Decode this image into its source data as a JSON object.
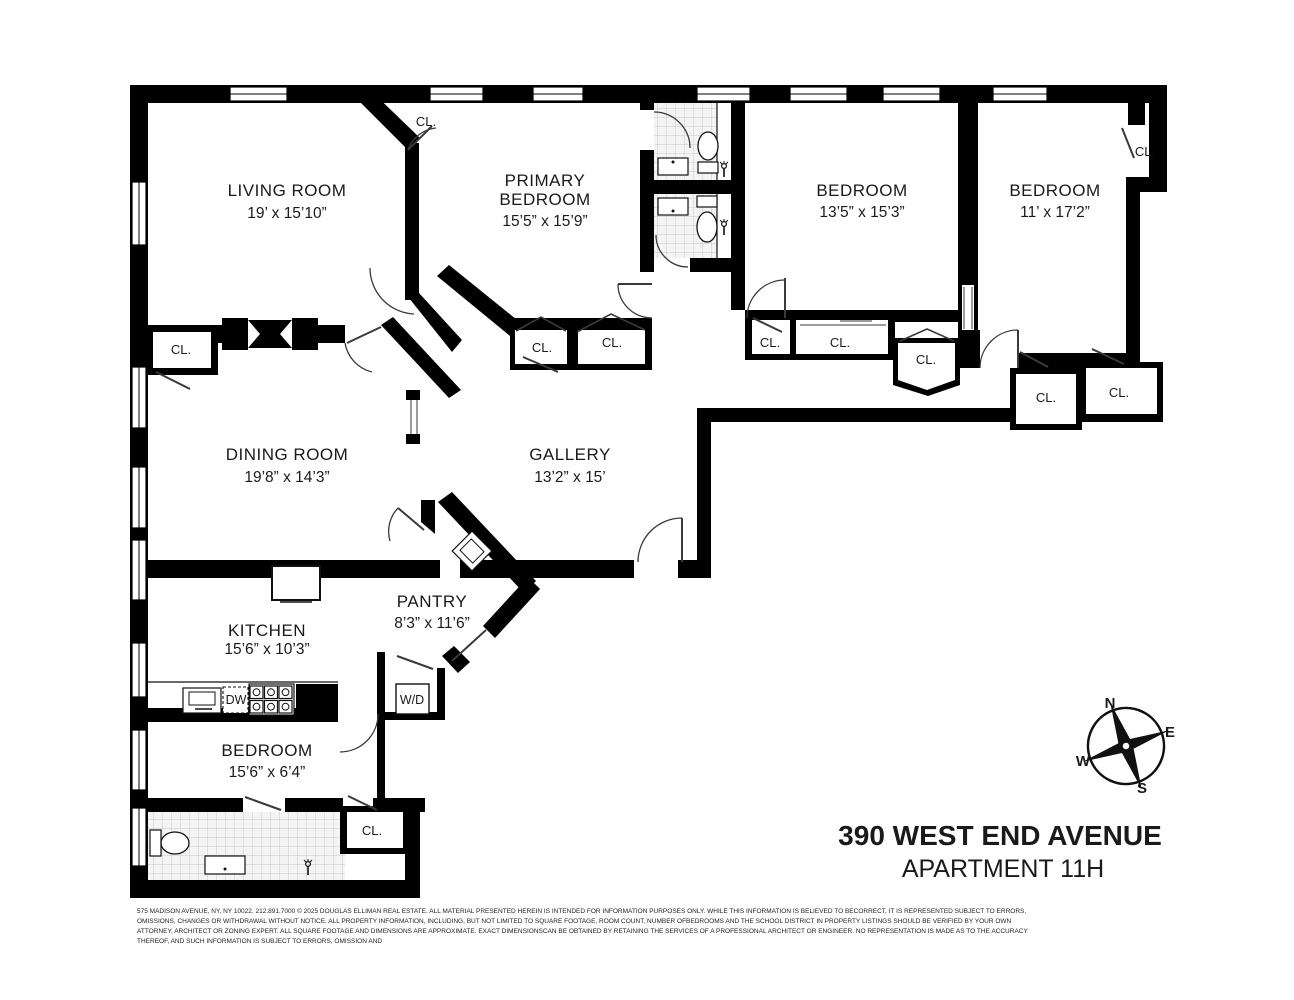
{
  "title": {
    "address": "390 WEST END AVENUE",
    "unit": "APARTMENT 11H"
  },
  "rooms": {
    "living": {
      "name": "LIVING ROOM",
      "dims": "19’ x 15’10”"
    },
    "primary": {
      "name1": "PRIMARY",
      "name2": "BEDROOM",
      "dims": "15’5” x 15’9”"
    },
    "bedroom2": {
      "name": "BEDROOM",
      "dims": "13’5” x 15’3”"
    },
    "bedroom3": {
      "name": "BEDROOM",
      "dims": "11’ x 17’2”"
    },
    "dining": {
      "name": "DINING ROOM",
      "dims": "19’8” x 14’3”"
    },
    "gallery": {
      "name": "GALLERY",
      "dims": "13’2” x 15’"
    },
    "pantry": {
      "name": "PANTRY",
      "dims": "8’3” x 11’6”"
    },
    "kitchen": {
      "name": "KITCHEN",
      "dims": "15’6” x 10’3”"
    },
    "bedroom4": {
      "name": "BEDROOM",
      "dims": "15’6” x 6’4”"
    }
  },
  "labels": {
    "closet": "CL.",
    "washer_dryer": "W/D",
    "dishwasher": "DW"
  },
  "compass": {
    "n": "N",
    "e": "E",
    "s": "S",
    "w": "W"
  },
  "colors": {
    "wall": "#000000",
    "background": "#ffffff",
    "tile_fill": "#f4f4f4",
    "tile_line": "#c9c9c9",
    "door_arc": "#3a3a3a"
  },
  "disclaimer": {
    "line1": "575 MADISON AVENUE, NY, NY 10022. 212.891.7000 © 2025 DOUGLAS ELLIMAN REAL ESTATE. ALL MATERIAL PRESENTED HEREIN IS INTENDED FOR INFORMATION PURPOSES ONLY. WHILE THIS INFORMATION IS BELIEVED TO BECORRECT, IT IS REPRESENTED SUBJECT TO ERRORS,",
    "line2": "OMISSIONS, CHANGES OR WITHDRAWAL WITHOUT NOTICE. ALL PROPERTY INFORMATION, INCLUDING, BUT NOT LIMITED TO SQUARE FOOTAGE, ROOM COUNT, NUMBER OFBEDROOMS AND THE SCHOOL DISTRICT IN PROPERTY LISTINGS SHOULD BE VERIFIED BY YOUR OWN",
    "line3": "ATTORNEY, ARCHITECT OR ZONING EXPERT. ALL SQUARE FOOTAGE AND DIMENSIONS ARE APPROXIMATE. EXACT DIMENSIONSCAN BE OBTAINED BY RETAINING THE SERVICES OF A PROFESSIONAL ARCHITECT OR ENGINEER. NO REPRESENTATION IS MADE AS TO THE ACCURACY",
    "line4": "THEREOF, AND SUCH INFORMATION IS SUBJECT TO ERRORS, OMISSION AND"
  }
}
